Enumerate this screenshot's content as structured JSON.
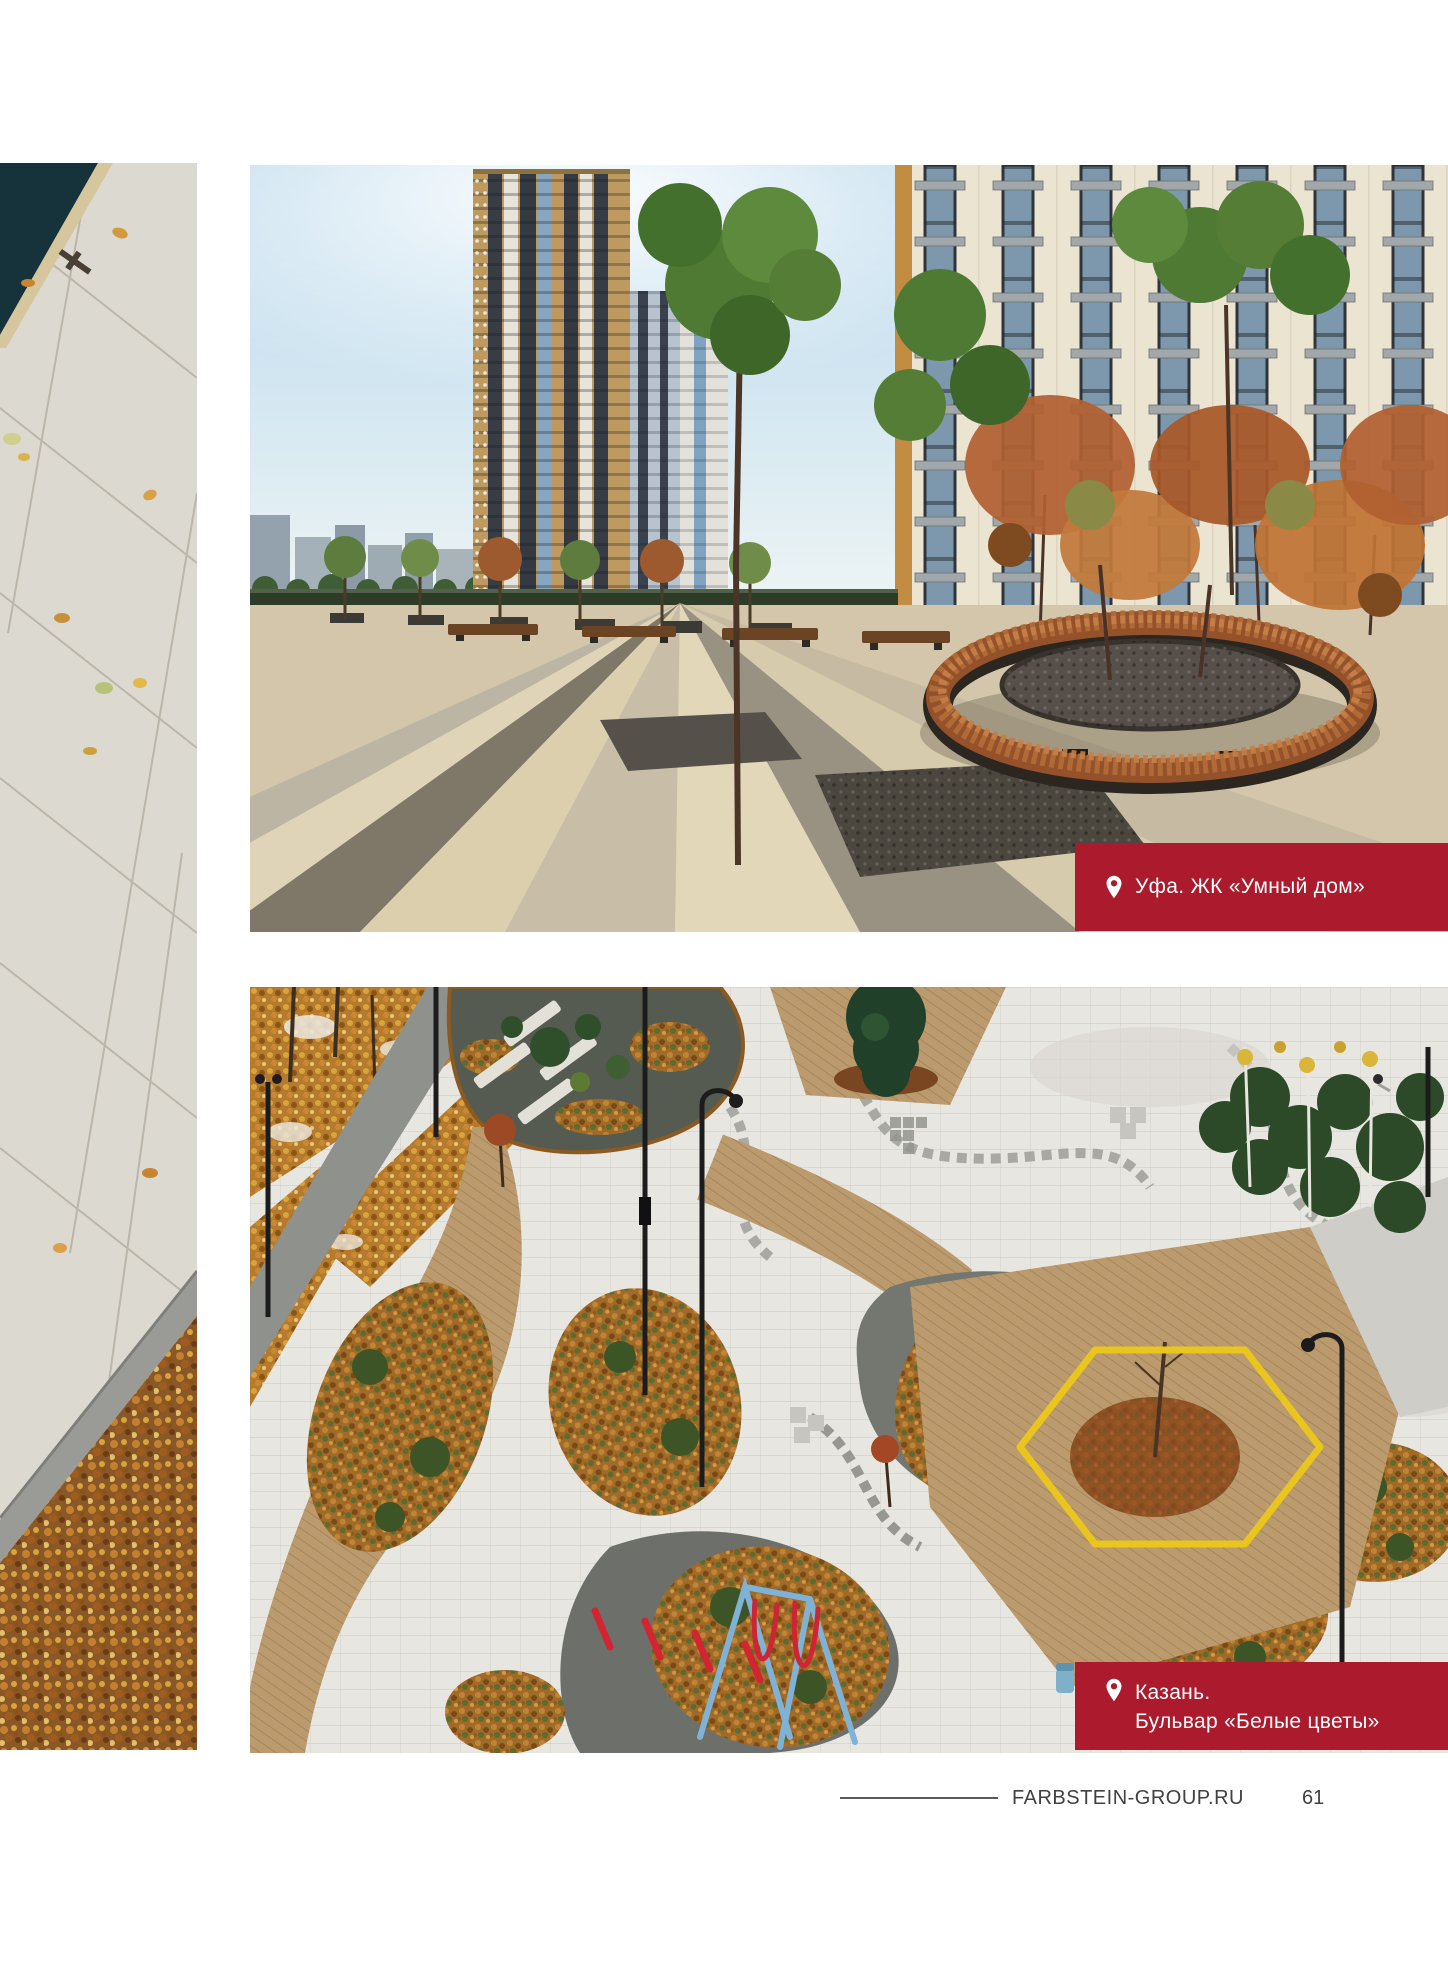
{
  "page": {
    "background": "#ffffff",
    "footer": {
      "website": "FARBSTEIN-GROUP.RU",
      "page_number": "61"
    }
  },
  "colors": {
    "caption_red": "#ab1a2d",
    "caption_text": "#ffffff",
    "footer_text": "#414042",
    "footer_rule": "#58595b"
  },
  "photos": {
    "top": {
      "caption": "Уфа. ЖК «Умный дом»"
    },
    "bottom": {
      "caption_line1": "Казань.",
      "caption_line2": "Бульвар «Белые цветы»"
    }
  },
  "icons": {
    "location_pin": "map-pin"
  }
}
